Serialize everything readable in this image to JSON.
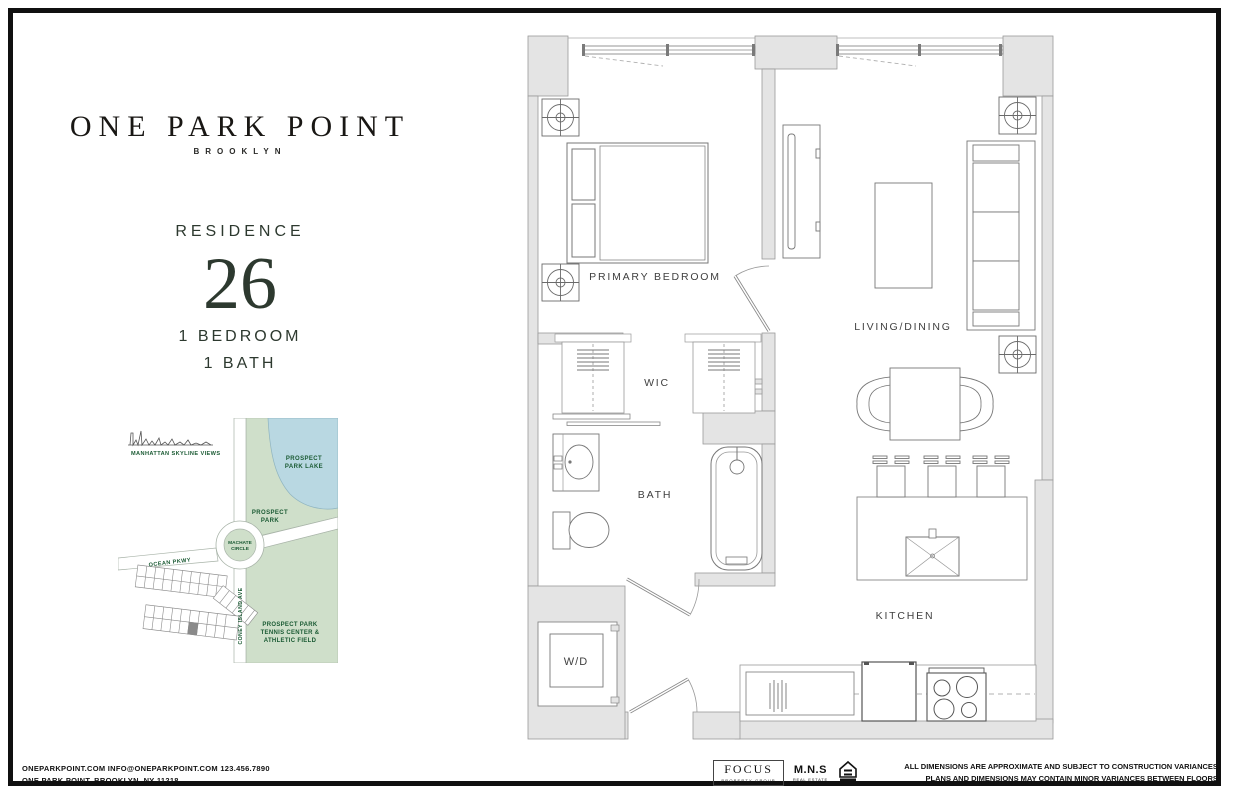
{
  "branding": {
    "name": "ONE PARK POINT",
    "sub": "BROOKLYN"
  },
  "residence": {
    "label": "RESIDENCE",
    "number": "26",
    "line1": "1 BEDROOM",
    "line2": "1 BATH"
  },
  "map": {
    "skyline_label": "MANHATTAN SKYLINE VIEWS",
    "lake_line1": "PROSPECT",
    "lake_line2": "PARK LAKE",
    "park_line1": "PROSPECT",
    "park_line2": "PARK",
    "circle_line1": "MACHATE",
    "circle_line2": "CIRCLE",
    "ocean_pkwy": "OCEAN PKWY",
    "coney_island_ave": "CONEY ISLAND AVE",
    "tennis_line1": "PROSPECT PARK",
    "tennis_line2": "TENNIS CENTER &",
    "tennis_line3": "ATHLETIC FIELD",
    "colors": {
      "park_green": "#cfdfca",
      "lake_blue": "#b9d8e2",
      "label_green": "#1a5a33"
    }
  },
  "floorplan": {
    "primary_bedroom": "PRIMARY BEDROOM",
    "living_dining": "LIVING/DINING",
    "wic": "WIC",
    "bath": "BATH",
    "kitchen": "KITCHEN",
    "wd": "W/D"
  },
  "footer": {
    "contact_line1": "ONEPARKPOINT.COM   INFO@ONEPARKPOINT.COM   123.456.7890",
    "contact_line2": "ONE PARK POINT, BROOKLYN, NY 11218",
    "focus": "FOCUS",
    "focus_sub": "PROPERTY GROUP",
    "mns": "M.N.S",
    "mns_sub": "REAL ESTATE",
    "disclaimer_line1": "ALL DIMENSIONS ARE APPROXIMATE AND SUBJECT TO CONSTRUCTION VARIANCES.",
    "disclaimer_line2": "PLANS AND DIMENSIONS MAY CONTAIN MINOR VARIANCES BETWEEN FLOORS."
  }
}
